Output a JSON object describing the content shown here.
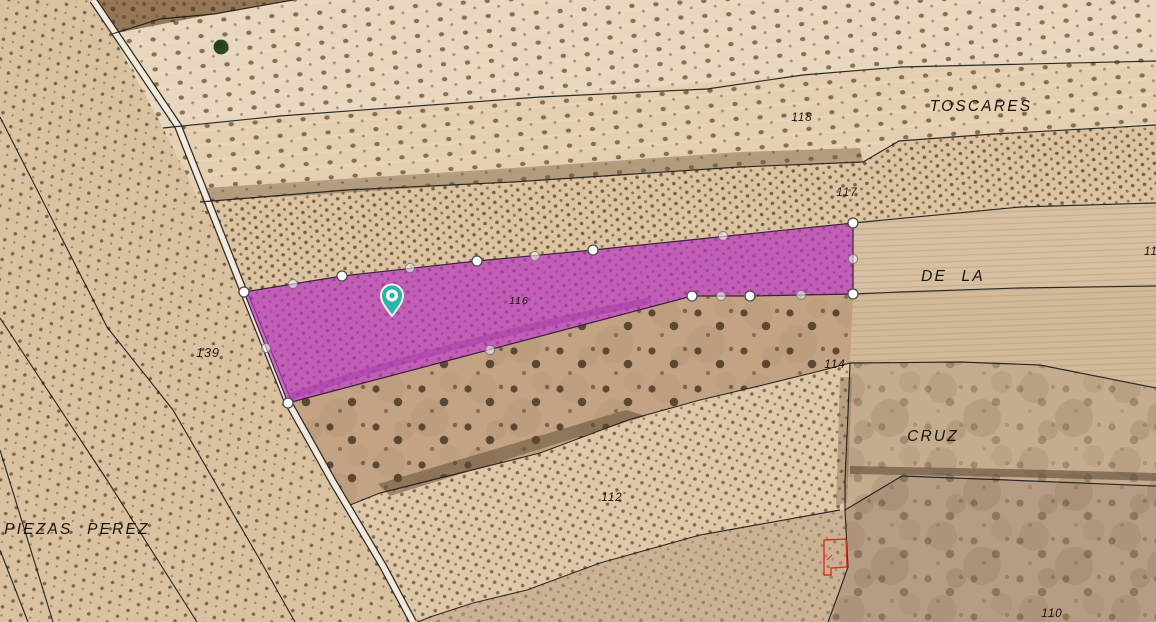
{
  "map": {
    "description": "Cadastral parcel map over satellite farmland imagery",
    "region_names": [
      {
        "text": "TOSCARES"
      },
      {
        "text": "DE LA"
      },
      {
        "text": "CRUZ"
      },
      {
        "text": "PIEZAS PEREZ"
      }
    ],
    "parcel_numbers": [
      {
        "text": "118"
      },
      {
        "text": "117"
      },
      {
        "text": "116"
      },
      {
        "text": "139"
      },
      {
        "text": "114"
      },
      {
        "text": "112"
      },
      {
        "text": "110"
      },
      {
        "text": "11"
      }
    ],
    "selected_parcel": {
      "number": "116",
      "fill_color": "#b836c0",
      "fill_opacity": 0.7,
      "outline_color": "#3a2239",
      "vertices": [
        [
          244,
          292
        ],
        [
          342,
          276
        ],
        [
          477,
          261
        ],
        [
          593,
          250
        ],
        [
          853,
          223
        ],
        [
          853,
          294
        ],
        [
          750,
          296
        ],
        [
          692,
          296
        ],
        [
          288,
          403
        ]
      ],
      "midpoints": [
        [
          293,
          284
        ],
        [
          410,
          268
        ],
        [
          535,
          256
        ],
        [
          723,
          236
        ],
        [
          853,
          259
        ],
        [
          801,
          295
        ],
        [
          721,
          296
        ],
        [
          490,
          350
        ],
        [
          266,
          348
        ]
      ]
    },
    "marker_pin": {
      "x": 392,
      "y": 316,
      "color": "#2cb5aa"
    },
    "colors": {
      "boundary_line": "#1c1c1c",
      "building_outline_red": "#e03020",
      "track_road": "#f2ebdd",
      "terrain_base": "#d3bc9d"
    }
  }
}
